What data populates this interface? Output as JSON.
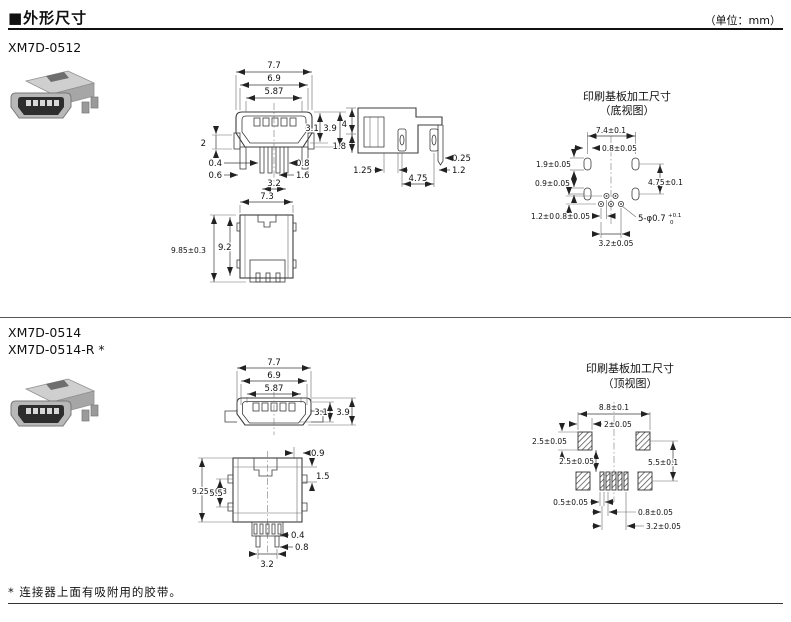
{
  "header": {
    "title": "■外形尺寸",
    "unit": "（单位：mm）"
  },
  "footnote": "* 连接器上面有吸附用的胶带。",
  "section1": {
    "model": "XM7D-0512",
    "front": {
      "w1": "7.7",
      "w2": "6.9",
      "w3": "5.87",
      "h1": "3.1",
      "h2": "3.9",
      "l2": "2",
      "l04": "0.4",
      "l06": "0.6",
      "r08": "0.8",
      "r16": "1.6",
      "b32": "3.2",
      "b73": "7.3"
    },
    "side": {
      "h4": "4",
      "h18": "1.8",
      "r025": "0.25",
      "l125": "1.25",
      "r12": "1.2",
      "b475": "4.75"
    },
    "bottom": {
      "h985": "9.85±0.3",
      "h92": "9.2"
    },
    "pcb": {
      "title": "印刷基板加工尺寸",
      "view": "（底视图）",
      "w74": "7.4±0.1",
      "t08": "0.8±0.05",
      "l19": "1.9±0.05",
      "l09": "0.9±0.05",
      "l12": "1.2±0.05",
      "b08": "0.8±0.05",
      "b32": "3.2±0.05",
      "r475": "4.75±0.1",
      "holes": "5-φ0.7",
      "tol_hi": "+0.1",
      "tol_lo": "0"
    }
  },
  "section2": {
    "model_a": "XM7D-0514",
    "model_b": "XM7D-0514-R *",
    "front": {
      "w1": "7.7",
      "w2": "6.9",
      "w3": "5.87",
      "h1": "3.1",
      "h2": "3.9"
    },
    "top": {
      "t09": "0.9",
      "r15": "1.5",
      "h925": "9.25±0.3",
      "h55": "5.5",
      "p04": "0.4",
      "p08": "0.8",
      "b32": "3.2"
    },
    "pcb": {
      "title": "印刷基板加工尺寸",
      "view": "（顶视图）",
      "w88": "8.8±0.1",
      "t2": "2±0.05",
      "l25": "2.5±0.05",
      "c25": "2.5±0.05",
      "r55": "5.5±0.1",
      "b05": "0.5±0.05",
      "b08": "0.8±0.05",
      "b32": "3.2±0.05"
    }
  }
}
